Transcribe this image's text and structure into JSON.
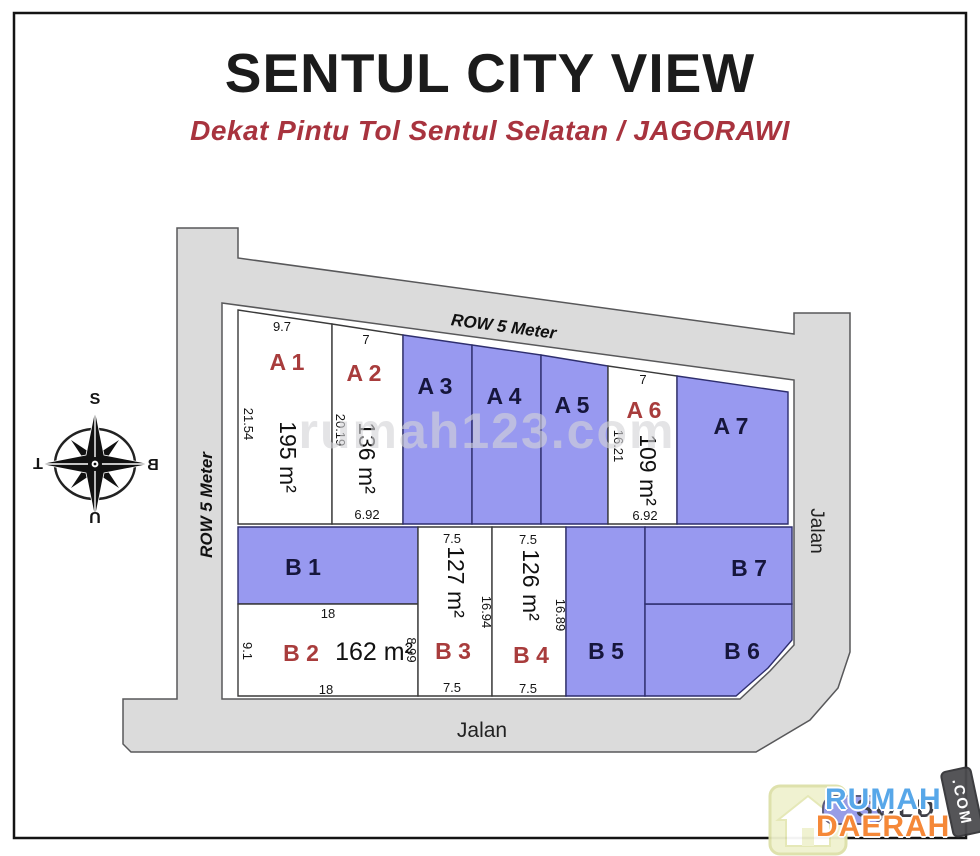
{
  "title": "SENTUL CITY VIEW",
  "subtitle": "Dekat Pintu Tol Sentul Selatan / JAGORAWI",
  "watermark": "rumah123.com",
  "compass": {
    "top": "S",
    "right": "B",
    "bottom": "U",
    "left": "T"
  },
  "roads": {
    "top_row": "ROW 5 Meter",
    "left_row": "ROW 5 Meter",
    "right_street": "Jalan",
    "bottom_street": "Jalan"
  },
  "plots": [
    {
      "label": "A 1",
      "label_color": "#a83c3c",
      "fill": "#ffffff",
      "area": "195 m²",
      "dim_top": "9.7",
      "dim_left": "21.54"
    },
    {
      "label": "A 2",
      "label_color": "#a83c3c",
      "fill": "#ffffff",
      "area": "136 m²",
      "dim_top": "7",
      "dim_left": "20.19",
      "dim_bottom": "6.92"
    },
    {
      "label": "A 3",
      "label_color": "#16163c",
      "fill": "#9899f0"
    },
    {
      "label": "A 4",
      "label_color": "#16163c",
      "fill": "#9899f0"
    },
    {
      "label": "A 5",
      "label_color": "#16163c",
      "fill": "#9899f0"
    },
    {
      "label": "A 6",
      "label_color": "#a83c3c",
      "fill": "#ffffff",
      "area": "109 m²",
      "dim_top": "7",
      "dim_left": "16.21",
      "dim_bottom": "6.92"
    },
    {
      "label": "A 7",
      "label_color": "#16163c",
      "fill": "#9899f0"
    },
    {
      "label": "B 1",
      "label_color": "#16163c",
      "fill": "#9899f0"
    },
    {
      "label": "B 2",
      "label_color": "#a83c3c",
      "fill": "#ffffff",
      "area": "162 m²",
      "dim_top": "18",
      "dim_bottom": "18",
      "dim_left": "9.1",
      "dim_right": "8.99"
    },
    {
      "label": "B 3",
      "label_color": "#a83c3c",
      "fill": "#ffffff",
      "area": "127 m²",
      "dim_top": "7.5",
      "dim_bottom": "7.5",
      "dim_right": "16.94"
    },
    {
      "label": "B 4",
      "label_color": "#a83c3c",
      "fill": "#ffffff",
      "area": "126 m²",
      "dim_top": "7.5",
      "dim_bottom": "7.5",
      "dim_right": "16.89"
    },
    {
      "label": "B 5",
      "label_color": "#16163c",
      "fill": "#9899f0"
    },
    {
      "label": "B 6",
      "label_color": "#16163c",
      "fill": "#9899f0"
    },
    {
      "label": "B 7",
      "label_color": "#16163c",
      "fill": "#9899f0"
    }
  ],
  "logo": {
    "word1": "RUMAH",
    "word2": "DAERAH",
    "badge": ".COM",
    "stamp": "SOLD"
  },
  "colors": {
    "plot_sold": "#9899f0",
    "plot_open": "#ffffff",
    "road": "#dbdbdb",
    "label_red": "#a83c3c",
    "label_dark": "#16163c",
    "subtitle_red": "#a8333e",
    "title_black": "#1b1b1b"
  }
}
